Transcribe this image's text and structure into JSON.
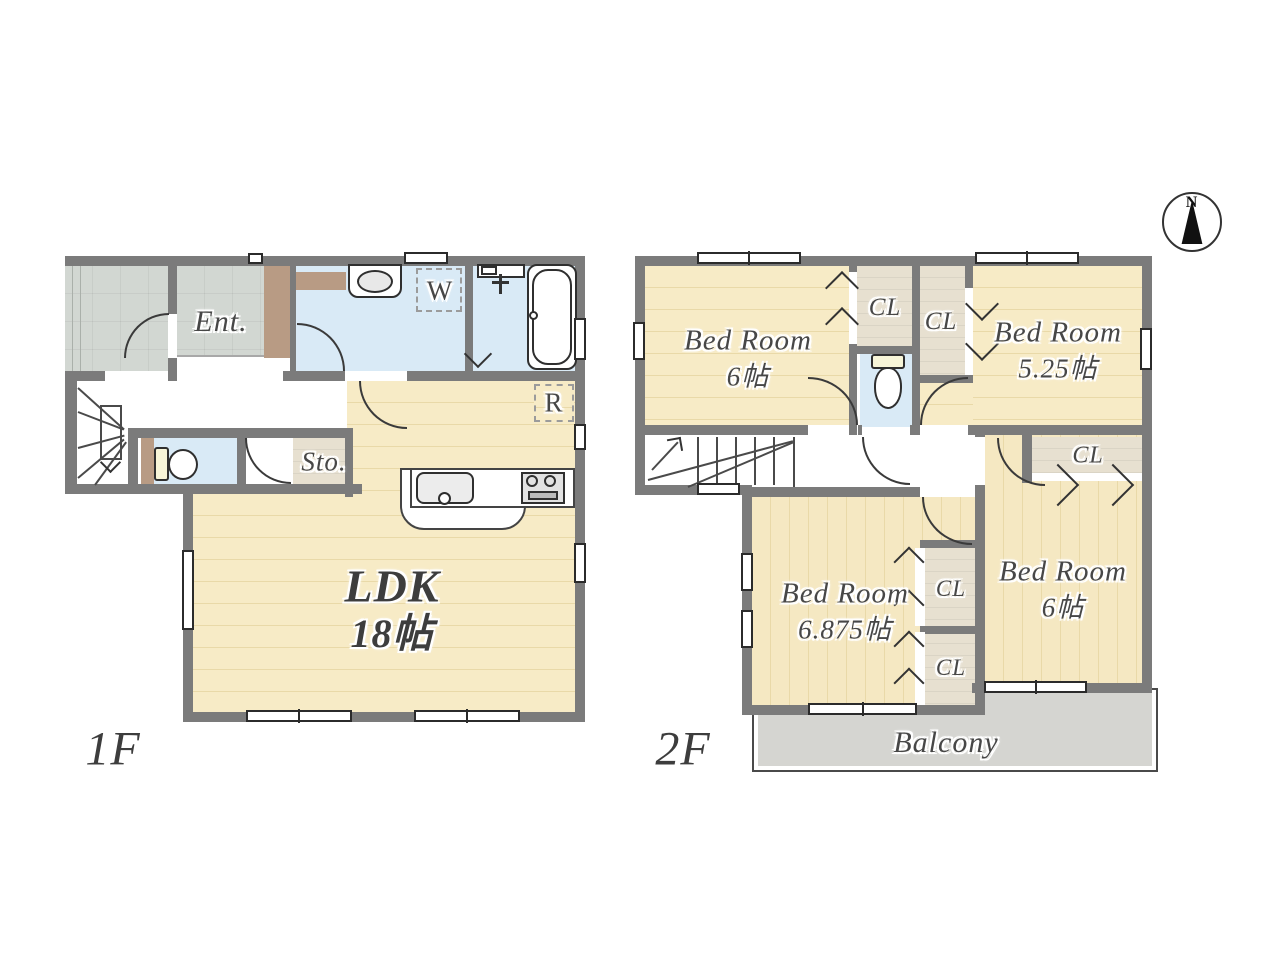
{
  "compass": {
    "north_label": "N"
  },
  "floor1": {
    "label": "1F",
    "entrance_label": "Ent.",
    "storage_label": "Sto.",
    "ldk_label": "LDK",
    "ldk_size": "18帖",
    "washer_label": "W",
    "fridge_label": "R"
  },
  "floor2": {
    "label": "2F",
    "bedroom_nw": {
      "name": "Bed Room",
      "size": "6帖"
    },
    "bedroom_ne": {
      "name": "Bed Room",
      "size": "5.25帖"
    },
    "bedroom_sw": {
      "name": "Bed Room",
      "size": "6.875帖"
    },
    "bedroom_se": {
      "name": "Bed Room",
      "size": "6帖"
    },
    "closet_label": "CL",
    "balcony_label": "Balcony"
  },
  "colors": {
    "wall": "#7b7b7b",
    "wood_floor": "#f6ead9",
    "tile_floor": "#e0e5e0",
    "water_room": "#d9eaf6",
    "accent_brown": "#b89b84",
    "closet_beige": "#f0e9d8",
    "balcony_gray": "#d5d5d1",
    "label_text": "#474747"
  }
}
